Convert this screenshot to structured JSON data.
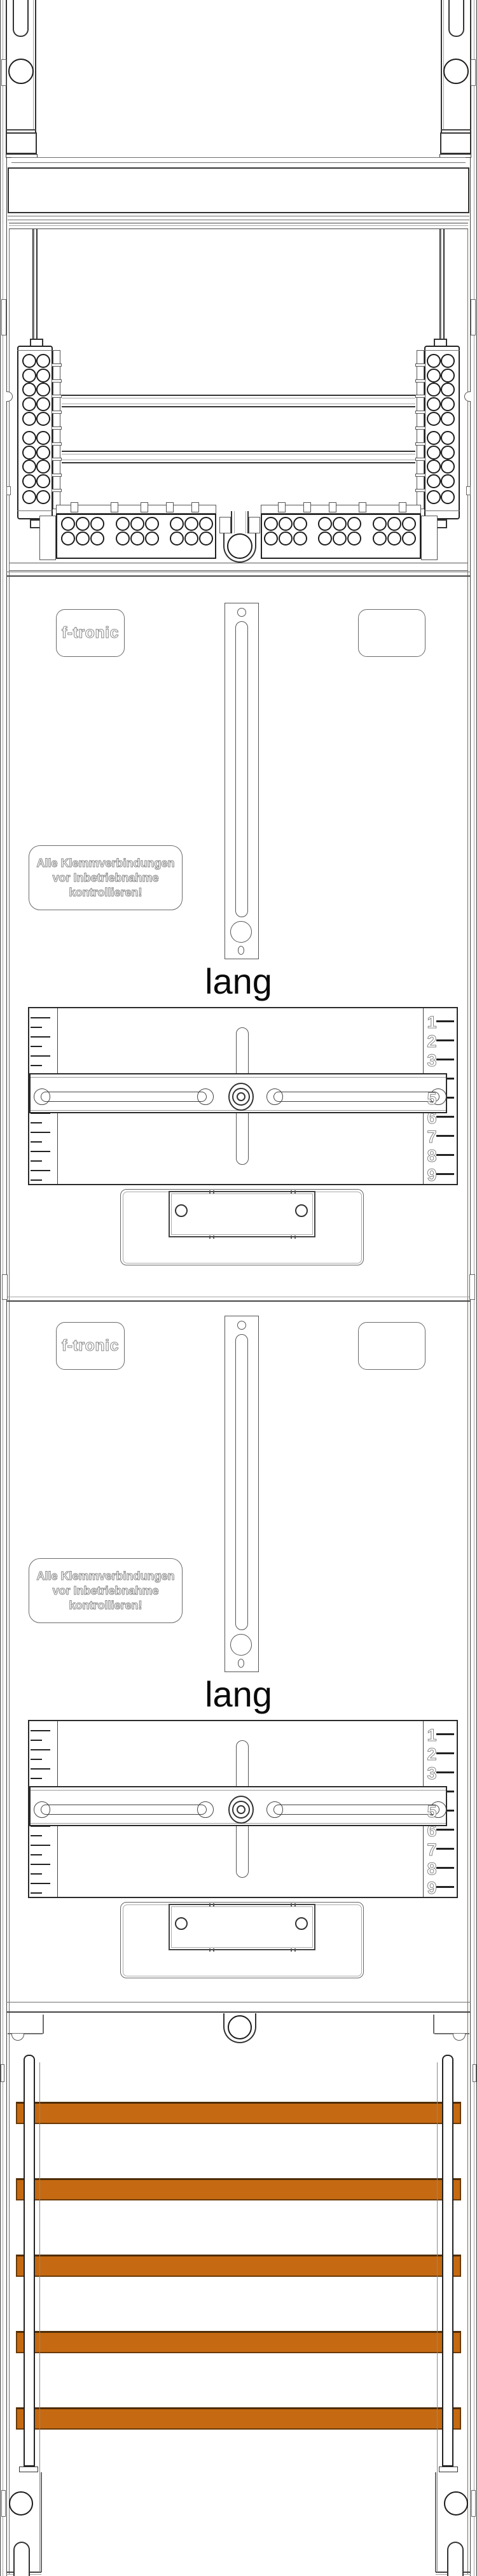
{
  "brand": {
    "logo_text": "f-tronic"
  },
  "panels": [
    {
      "logo": "f-tronic",
      "warning_line1": "Alle Klemmverbindungen",
      "warning_line2": "vor Inbetriebnahme",
      "warning_line3": "kontrollieren!",
      "size_label": "lang"
    },
    {
      "logo": "f-tronic",
      "warning_line1": "Alle Klemmverbindungen",
      "warning_line2": "vor Inbetriebnahme",
      "warning_line3": "kontrollieren!",
      "size_label": "lang"
    }
  ],
  "ruler_numbers": [
    "1",
    "2",
    "3",
    "4",
    "5",
    "6",
    "7",
    "8",
    "9"
  ],
  "busbars": {
    "count": 5,
    "fill_color": "#c56a12",
    "edge_color": "#6b3a06",
    "edge_top_color": "#4f2d08"
  },
  "colors": {
    "line": "#333333",
    "outline_text": "#878787"
  }
}
